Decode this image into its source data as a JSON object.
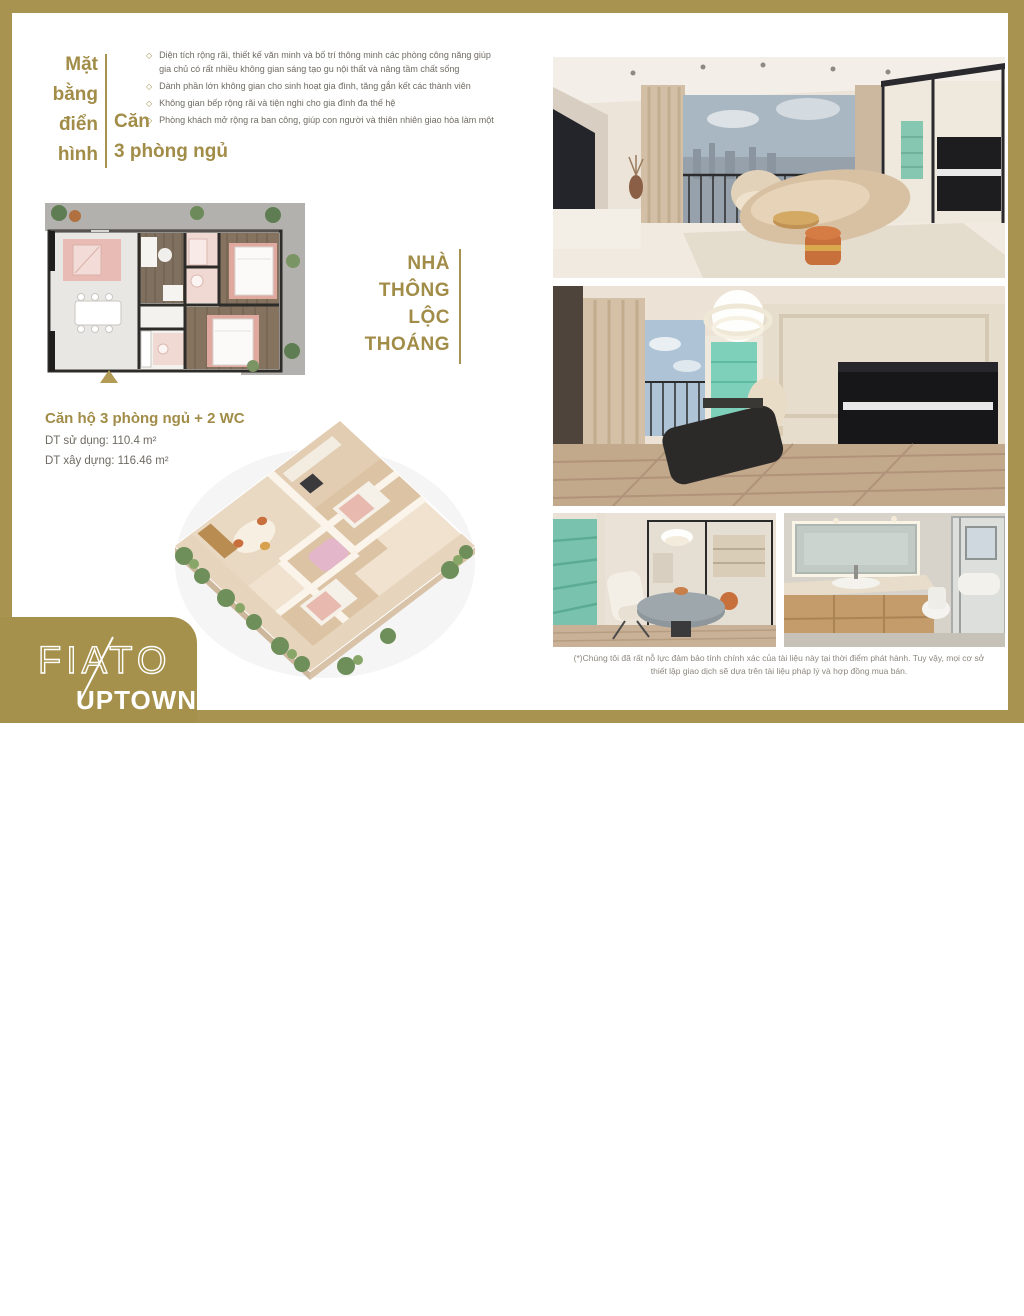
{
  "header": {
    "left_lines": [
      "Mặt",
      "bằng",
      "điển",
      "hình"
    ],
    "right_line1": "Căn",
    "right_line2": "3 phòng ngủ",
    "bullets": [
      "Diện tích rộng rãi, thiết kế văn minh và bố trí thông minh các phòng công năng giúp gia chủ có rất nhiều không gian sáng tạo gu nội thất và nâng tầm chất sống",
      "Dành phần lớn không gian cho sinh hoạt gia đình, tăng gắn kết các thành viên",
      "Không gian bếp rộng rãi và tiện nghi cho gia đình đa thế hệ",
      "Phòng khách mở rộng ra ban công, giúp con người và thiên nhiên giao hòa làm một"
    ]
  },
  "unit_info": {
    "title": "Căn hộ 3 phòng ngủ + 2 WC",
    "area_usable": "DT sử dụng: 110.4 m²",
    "area_built": "DT xây dựng: 116.46 m²"
  },
  "tagline": {
    "lines": [
      "NHÀ",
      "THÔNG",
      "LỘC",
      "THOÁNG"
    ]
  },
  "footer": {
    "note_line1": "(*)Chúng tôi đã rất nỗ lực đảm bảo tính chính xác của tài liệu này tại thời điểm phát hành. Tuy vậy, mọi cơ sở",
    "note_line2": "thiết lập giao dịch sẽ dựa trên tài liệu pháp lý và hợp đồng mua bán."
  },
  "logo": {
    "brand": "FIATO",
    "sub": "UPTOWN"
  },
  "watermark": {
    "label": "Batdongsan"
  },
  "colors": {
    "gold_frame": "#a89350",
    "gold_text": "#a18c48",
    "body_text": "#6f6b63"
  }
}
